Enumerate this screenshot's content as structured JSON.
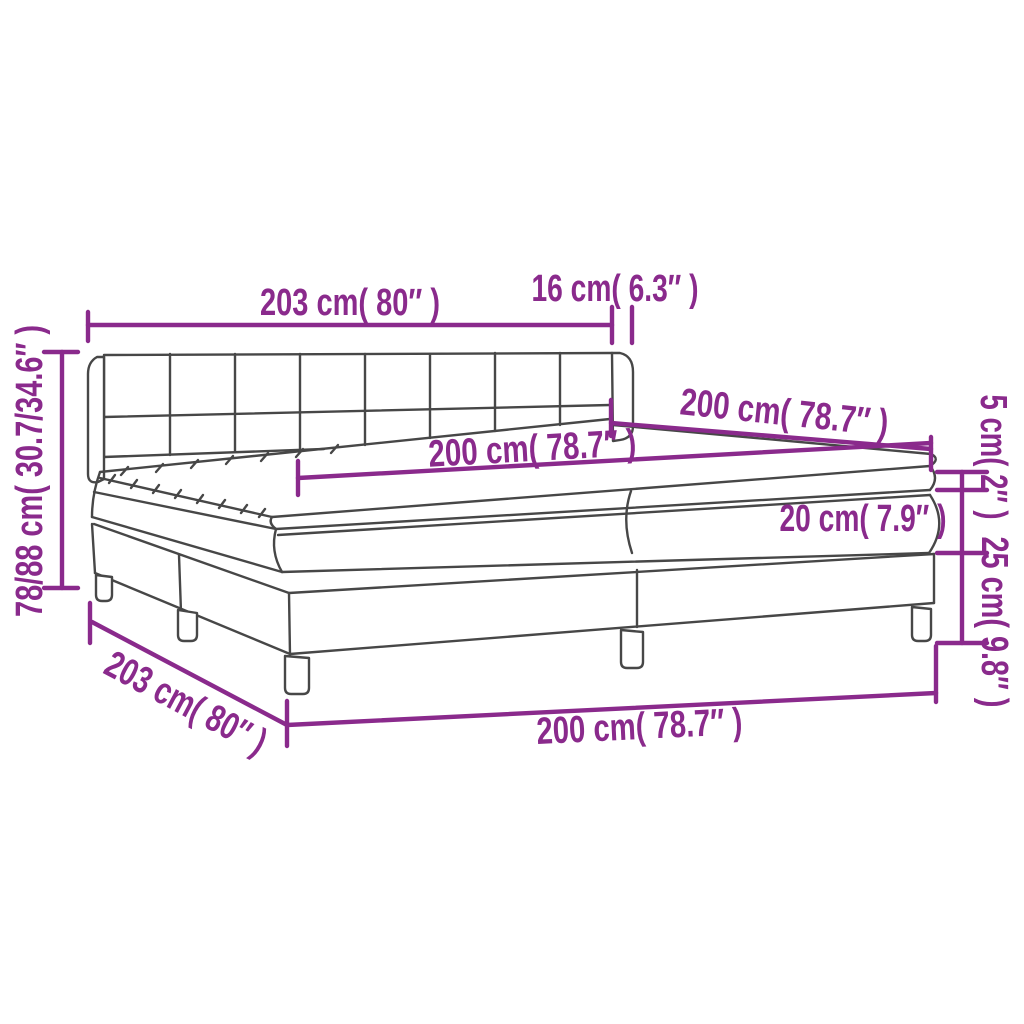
{
  "figure": {
    "type": "product-dimension-diagram",
    "subject": "box spring bed with headboard, mattress and topper",
    "background_color": "#ffffff"
  },
  "colors": {
    "dimension_annotations": "#8A2A8C",
    "drawing_outline": "#474747"
  },
  "labels": {
    "bed_width_top": "203 cm( 80″ )",
    "headboard_depth": "16 cm( 6.3″ )",
    "mattress_width": "200 cm( 78.7″ )",
    "mattress_length": "200 cm( 78.7″ )",
    "topper_height": "5 cm( 2″ )",
    "mattress_height": "20 cm( 7.9″ )",
    "base_height": "25 cm( 9.8″ )",
    "total_height": "78/88 cm( 30.7/34.6″ )",
    "bed_width_bottom": "203 cm( 80″ )",
    "bed_length_bottom": "200 cm( 78.7″ )"
  }
}
